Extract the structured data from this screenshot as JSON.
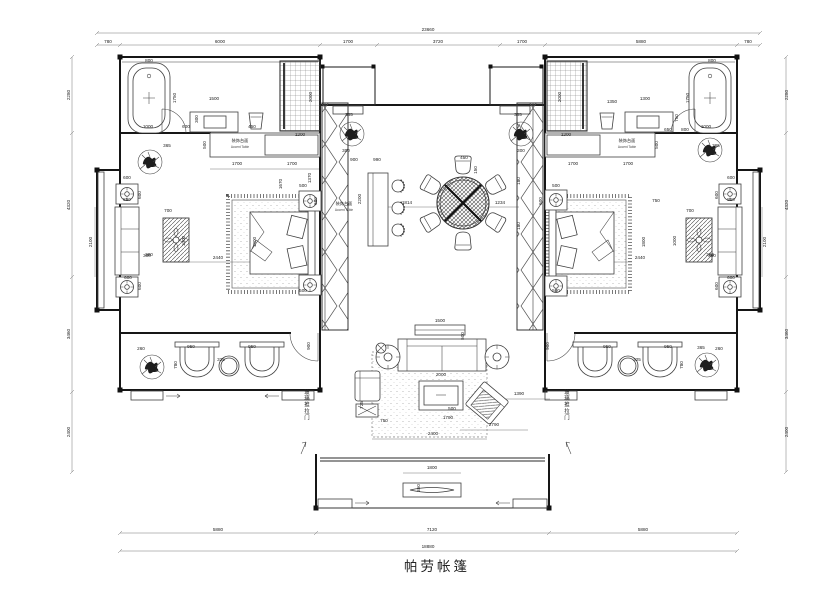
{
  "title": {
    "text": "帕劳帐篷"
  },
  "labels": {
    "accent_table_zh": "装饰台面",
    "accent_table_en": "Accent Table",
    "sliding_door": "玻璃推拉门"
  },
  "colors": {
    "line": "#3f3f3f",
    "wall": "#161616",
    "text": "#1a1a1a",
    "bg": "#ffffff"
  },
  "annotations": [
    {
      "t": "玻璃推拉门",
      "x": 306,
      "y": 405,
      "v": true
    },
    {
      "t": "玻璃推拉门",
      "x": 566,
      "y": 405,
      "v": true
    }
  ],
  "dimensions": [
    {
      "t": "23660",
      "x": 428,
      "y": 31
    },
    {
      "t": "780",
      "x": 108,
      "y": 43
    },
    {
      "t": "6000",
      "x": 220,
      "y": 43
    },
    {
      "t": "1700",
      "x": 348,
      "y": 43
    },
    {
      "t": "3720",
      "x": 438,
      "y": 43
    },
    {
      "t": "1700",
      "x": 522,
      "y": 43
    },
    {
      "t": "5880",
      "x": 641,
      "y": 43
    },
    {
      "t": "780",
      "x": 748,
      "y": 43
    },
    {
      "t": "5880",
      "x": 218,
      "y": 531
    },
    {
      "t": "7120",
      "x": 432,
      "y": 531
    },
    {
      "t": "5880",
      "x": 643,
      "y": 531
    },
    {
      "t": "18880",
      "x": 428,
      "y": 548
    },
    {
      "t": "2280",
      "x": 70,
      "y": 95,
      "r": -90
    },
    {
      "t": "4320",
      "x": 70,
      "y": 205,
      "r": -90
    },
    {
      "t": "3460",
      "x": 70,
      "y": 334,
      "r": -90
    },
    {
      "t": "2400",
      "x": 70,
      "y": 432,
      "r": -90
    },
    {
      "t": "2280",
      "x": 788,
      "y": 95,
      "r": -90
    },
    {
      "t": "4320",
      "x": 788,
      "y": 205,
      "r": -90
    },
    {
      "t": "3460",
      "x": 788,
      "y": 334,
      "r": -90
    },
    {
      "t": "2400",
      "x": 788,
      "y": 432,
      "r": -90
    },
    {
      "t": "800",
      "x": 149,
      "y": 62
    },
    {
      "t": "1750",
      "x": 176,
      "y": 98,
      "r": -90
    },
    {
      "t": "1000",
      "x": 148,
      "y": 128
    },
    {
      "t": "600",
      "x": 186,
      "y": 128
    },
    {
      "t": "1500",
      "x": 214,
      "y": 100
    },
    {
      "t": "300",
      "x": 198,
      "y": 119,
      "r": -90
    },
    {
      "t": "450",
      "x": 252,
      "y": 128
    },
    {
      "t": "2000",
      "x": 312,
      "y": 97,
      "r": -90
    },
    {
      "t": "1200",
      "x": 300,
      "y": 136
    },
    {
      "t": "500",
      "x": 206,
      "y": 145,
      "r": -90
    },
    {
      "t": "1700",
      "x": 237,
      "y": 165
    },
    {
      "t": "1700",
      "x": 292,
      "y": 165
    },
    {
      "t": "1670",
      "x": 282,
      "y": 184,
      "r": -90
    },
    {
      "t": "1370",
      "x": 311,
      "y": 178,
      "r": -90
    },
    {
      "t": "365",
      "x": 167,
      "y": 147
    },
    {
      "t": "500",
      "x": 303,
      "y": 187
    },
    {
      "t": "600",
      "x": 317,
      "y": 201,
      "r": -90
    },
    {
      "t": "700",
      "x": 168,
      "y": 212
    },
    {
      "t": "1000",
      "x": 185,
      "y": 241,
      "r": -90
    },
    {
      "t": "380",
      "x": 149,
      "y": 256
    },
    {
      "t": "2440",
      "x": 218,
      "y": 259
    },
    {
      "t": "1800",
      "x": 256,
      "y": 242,
      "r": -90
    },
    {
      "t": "500",
      "x": 303,
      "y": 292
    },
    {
      "t": "600",
      "x": 127,
      "y": 179
    },
    {
      "t": "600",
      "x": 141,
      "y": 195,
      "r": -90
    },
    {
      "t": "850",
      "x": 127,
      "y": 201
    },
    {
      "t": "2100",
      "x": 92,
      "y": 242,
      "r": -90
    },
    {
      "t": "300",
      "x": 147,
      "y": 257
    },
    {
      "t": "600",
      "x": 128,
      "y": 279
    },
    {
      "t": "600",
      "x": 141,
      "y": 286,
      "r": -90
    },
    {
      "t": "260",
      "x": 141,
      "y": 350
    },
    {
      "t": "950",
      "x": 191,
      "y": 348
    },
    {
      "t": "950",
      "x": 252,
      "y": 348
    },
    {
      "t": "325",
      "x": 221,
      "y": 361
    },
    {
      "t": "780",
      "x": 177,
      "y": 365,
      "r": -90
    },
    {
      "t": "900",
      "x": 310,
      "y": 346,
      "r": -90
    },
    {
      "t": "900",
      "x": 354,
      "y": 161
    },
    {
      "t": "990",
      "x": 377,
      "y": 161
    },
    {
      "t": "2200",
      "x": 361,
      "y": 199,
      "r": -90
    },
    {
      "t": "1814",
      "x": 407,
      "y": 204
    },
    {
      "t": "450",
      "x": 464,
      "y": 159
    },
    {
      "t": "150",
      "x": 477,
      "y": 170,
      "r": -90
    },
    {
      "t": "1234",
      "x": 500,
      "y": 204
    },
    {
      "t": "180",
      "x": 520,
      "y": 181,
      "r": -90
    },
    {
      "t": "180",
      "x": 520,
      "y": 226,
      "r": -90
    },
    {
      "t": "365",
      "x": 349,
      "y": 116
    },
    {
      "t": "300",
      "x": 346,
      "y": 152
    },
    {
      "t": "365",
      "x": 518,
      "y": 116
    },
    {
      "t": "300",
      "x": 521,
      "y": 152
    },
    {
      "t": "1500",
      "x": 440,
      "y": 322
    },
    {
      "t": "500",
      "x": 464,
      "y": 336,
      "r": -90
    },
    {
      "t": "2000",
      "x": 441,
      "y": 376
    },
    {
      "t": "725",
      "x": 363,
      "y": 405,
      "r": -90
    },
    {
      "t": "750",
      "x": 384,
      "y": 422
    },
    {
      "t": "500",
      "x": 452,
      "y": 410
    },
    {
      "t": "1790",
      "x": 448,
      "y": 419
    },
    {
      "t": "2400",
      "x": 433,
      "y": 435
    },
    {
      "t": "2790",
      "x": 494,
      "y": 426
    },
    {
      "t": "1390",
      "x": 519,
      "y": 395
    },
    {
      "t": "1800",
      "x": 432,
      "y": 469
    },
    {
      "t": "350",
      "x": 420,
      "y": 488,
      "r": -90
    },
    {
      "t": "800",
      "x": 712,
      "y": 62
    },
    {
      "t": "1750",
      "x": 689,
      "y": 98,
      "r": -90
    },
    {
      "t": "1000",
      "x": 706,
      "y": 128
    },
    {
      "t": "650",
      "x": 668,
      "y": 131
    },
    {
      "t": "800",
      "x": 685,
      "y": 131
    },
    {
      "t": "1300",
      "x": 645,
      "y": 100
    },
    {
      "t": "1350",
      "x": 612,
      "y": 103
    },
    {
      "t": "750",
      "x": 678,
      "y": 118,
      "r": -90
    },
    {
      "t": "2000",
      "x": 561,
      "y": 97,
      "r": -90
    },
    {
      "t": "1200",
      "x": 566,
      "y": 136
    },
    {
      "t": "500",
      "x": 658,
      "y": 145,
      "r": -90
    },
    {
      "t": "1700",
      "x": 573,
      "y": 165
    },
    {
      "t": "1700",
      "x": 628,
      "y": 165
    },
    {
      "t": "365",
      "x": 716,
      "y": 147
    },
    {
      "t": "500",
      "x": 556,
      "y": 187
    },
    {
      "t": "600",
      "x": 542,
      "y": 201,
      "r": -90
    },
    {
      "t": "700",
      "x": 690,
      "y": 212
    },
    {
      "t": "1000",
      "x": 676,
      "y": 241,
      "r": -90
    },
    {
      "t": "380",
      "x": 710,
      "y": 256
    },
    {
      "t": "2440",
      "x": 640,
      "y": 259
    },
    {
      "t": "1800",
      "x": 645,
      "y": 242,
      "r": -90
    },
    {
      "t": "500",
      "x": 556,
      "y": 292
    },
    {
      "t": "750",
      "x": 656,
      "y": 202
    },
    {
      "t": "600",
      "x": 731,
      "y": 179
    },
    {
      "t": "600",
      "x": 718,
      "y": 195,
      "r": -90
    },
    {
      "t": "850",
      "x": 731,
      "y": 201
    },
    {
      "t": "2100",
      "x": 766,
      "y": 242,
      "r": -90
    },
    {
      "t": "300",
      "x": 712,
      "y": 257
    },
    {
      "t": "600",
      "x": 731,
      "y": 279
    },
    {
      "t": "600",
      "x": 718,
      "y": 286,
      "r": -90
    },
    {
      "t": "950",
      "x": 607,
      "y": 348
    },
    {
      "t": "950",
      "x": 668,
      "y": 348
    },
    {
      "t": "325",
      "x": 637,
      "y": 361
    },
    {
      "t": "365",
      "x": 701,
      "y": 349
    },
    {
      "t": "780",
      "x": 683,
      "y": 365,
      "r": -90
    },
    {
      "t": "900",
      "x": 549,
      "y": 346,
      "r": -90
    },
    {
      "t": "260",
      "x": 719,
      "y": 350
    }
  ]
}
